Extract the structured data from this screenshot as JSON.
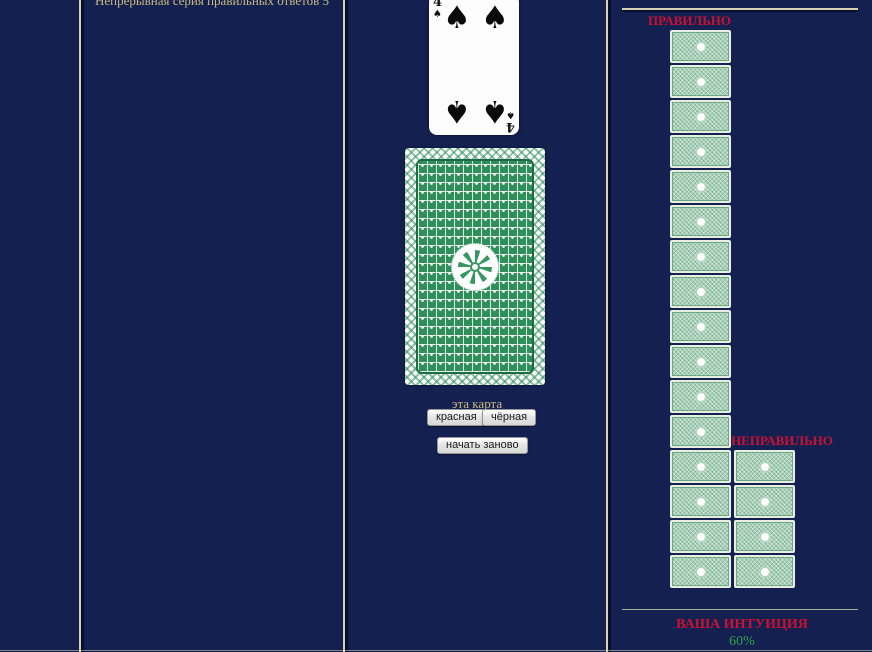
{
  "colors": {
    "background": "#142150",
    "divider_tan": "#d9d1b4",
    "heading_red": "#cc1133",
    "intuition_green": "#2fa04c",
    "gold_text": "#c9b97f",
    "card_back_green": "#2f8f5b",
    "mini_card_green": "#a6ceb4"
  },
  "streak": {
    "label": "Непрерывная серия правильных ответов 5"
  },
  "deck": {
    "revealed_card": {
      "rank": "4",
      "suit": "spades",
      "suit_symbol": "♠",
      "color": "black"
    },
    "prompt": "эта карта",
    "buttons": {
      "red": "красная",
      "black": "чёрная",
      "restart": "начать заново"
    }
  },
  "score": {
    "correct": {
      "label": "ПРАВИЛЬНО",
      "count": 16
    },
    "incorrect": {
      "label": "НЕПРАВИЛЬНО",
      "count": 4
    },
    "intuition": {
      "label": "ВАША ИНТУИЦИЯ",
      "value": "60%"
    }
  }
}
